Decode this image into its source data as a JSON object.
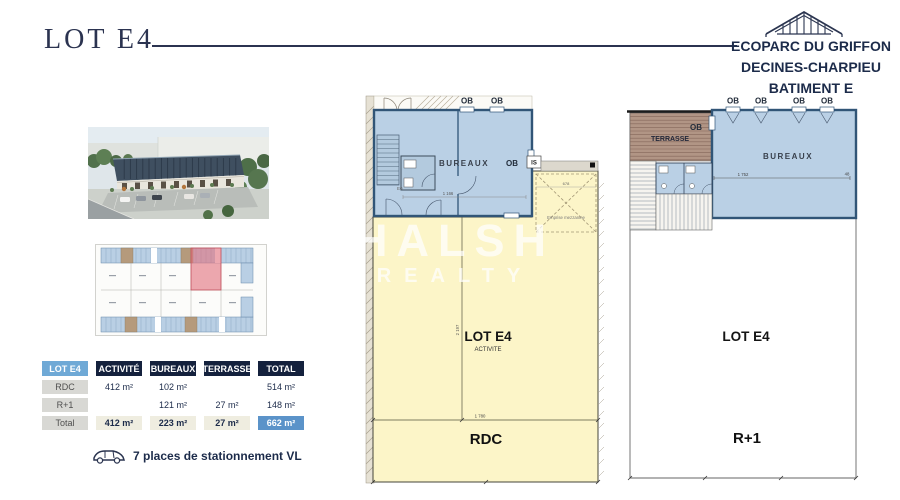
{
  "title": {
    "text": "LOT E4"
  },
  "brand": {
    "line1": "ECOPARC DU GRIFFON",
    "line2": "DECINES-CHARPIEU",
    "line3": "BATIMENT E"
  },
  "watermark": {
    "line1": "HALSH",
    "line2": "REALTY"
  },
  "table": {
    "headers": [
      "LOT E4",
      "ACTIVITÉ",
      "BUREAUX",
      "TERRASSE",
      "TOTAL"
    ],
    "rows": [
      {
        "label": "RDC",
        "activite": "412 m²",
        "bureaux": "102 m²",
        "terrasse": "",
        "total": "514 m²"
      },
      {
        "label": "R+1",
        "activite": "",
        "bureaux": "121 m²",
        "terrasse": "27 m²",
        "total": "148 m²"
      },
      {
        "label": "Total",
        "activite": "412 m²",
        "bureaux": "223 m²",
        "terrasse": "27 m²",
        "total": "662 m²"
      }
    ]
  },
  "parking": {
    "text": "7 places de stationnement VL"
  },
  "rdc": {
    "floor": "RDC",
    "lot": "LOT E4",
    "zone": "ACTIVITE",
    "bureaux": "BUREAUX",
    "ob": [
      "OB",
      "OB",
      "OB"
    ],
    "is": "IS",
    "stair": "E0",
    "mezzanine": "Emprise mezzanine",
    "dims": {
      "w_bureaux": "1 166",
      "w_annex": "678",
      "w_total": "1 780",
      "h_total": "2 197"
    }
  },
  "r1": {
    "floor": "R+1",
    "lot": "LOT E4",
    "terrasse": "TERRASSE",
    "bureaux": "BUREAUX",
    "ob": [
      "OB",
      "OB",
      "OB",
      "OB",
      "OB"
    ],
    "dims": {
      "w_bureaux": "1 752",
      "w_right": "48"
    }
  },
  "colors": {
    "navy": "#1c2b4a",
    "table_navy": "#14213d",
    "header_blue": "#6fa9d6",
    "total_blue": "#5b93c9",
    "plan_blue": "#bad0e5",
    "plan_wall": "#315577",
    "plan_yellow": "#fcf5c8",
    "terrasse_brown": "#b19585",
    "highlight_red": "#e2737f"
  }
}
